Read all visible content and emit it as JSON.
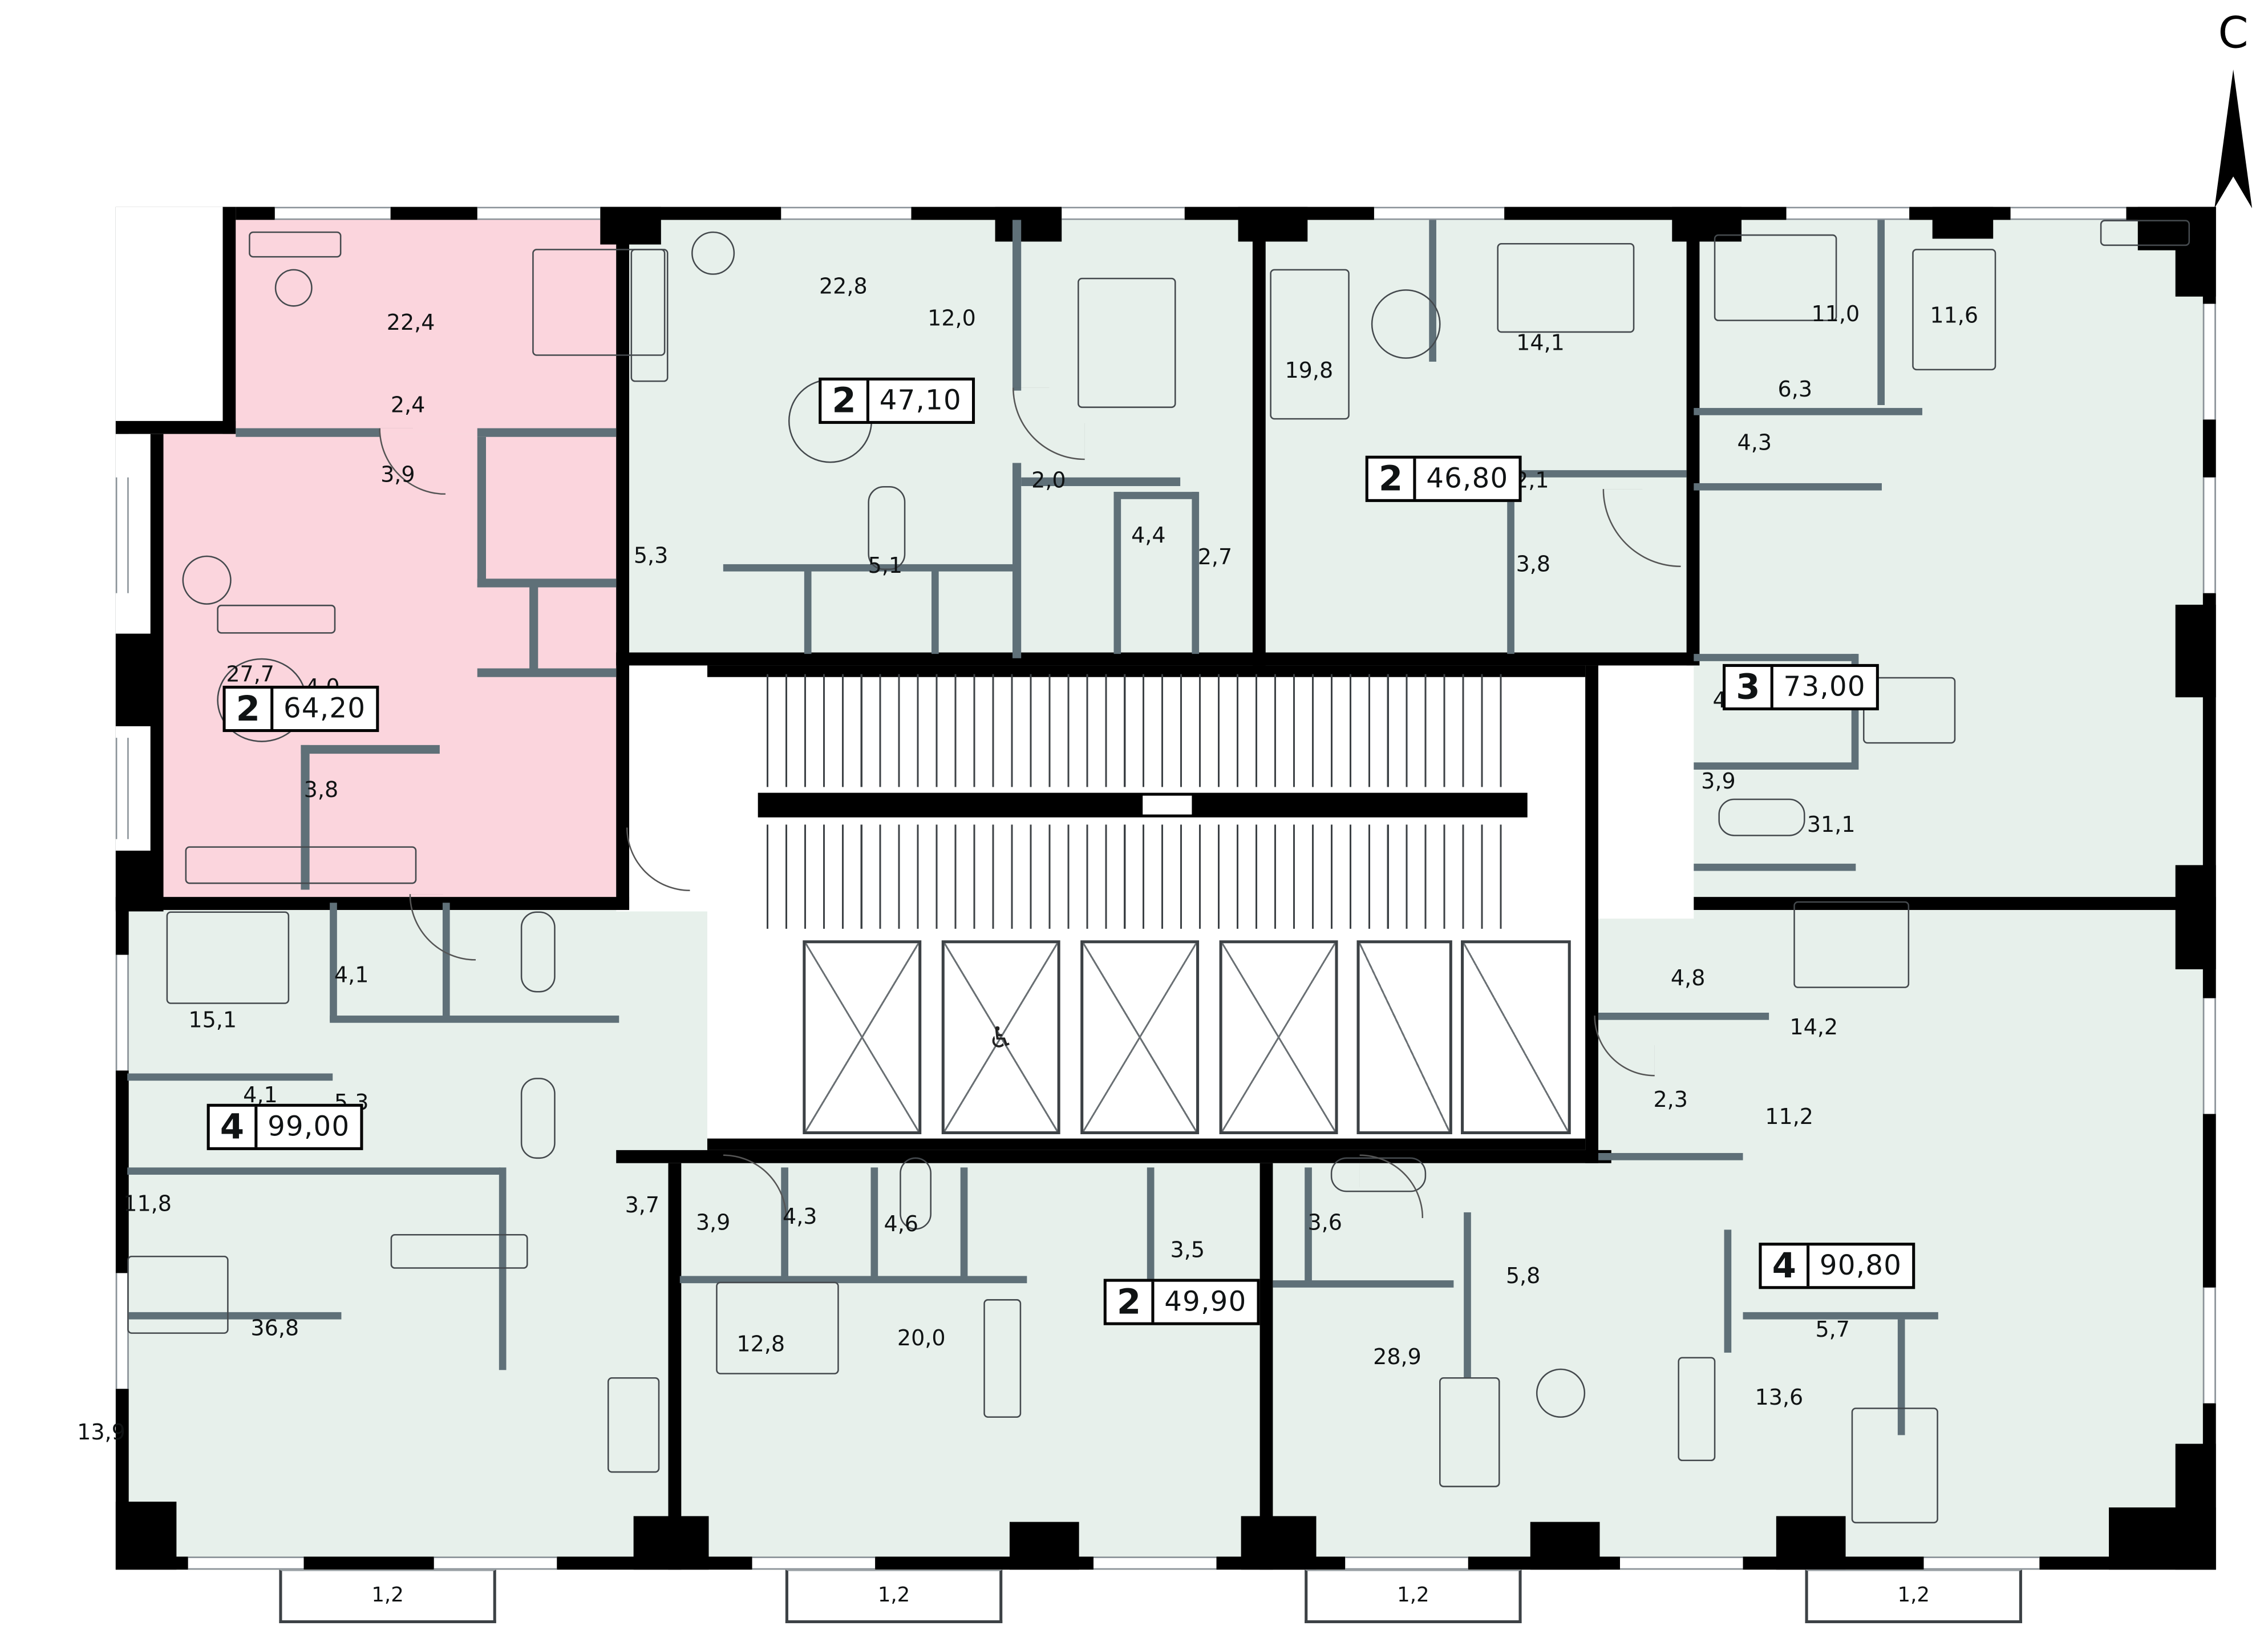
{
  "compass": {
    "label": "С"
  },
  "plan": {
    "balcony_labels": [
      "1,2",
      "1,2",
      "1,2",
      "1,2"
    ],
    "wheelchair_icon": "♿"
  },
  "apartments": [
    {
      "label": "2",
      "area": "64,20",
      "highlighted": true,
      "room_areas": [
        "22,4",
        "2,4",
        "3,9",
        "27,7",
        "4,0",
        "3,8"
      ]
    },
    {
      "label": "2",
      "area": "47,10",
      "highlighted": false,
      "room_areas": [
        "22,8",
        "12,0",
        "2,0",
        "5,3",
        "5,1"
      ]
    },
    {
      "label": "2",
      "area": "46,80",
      "highlighted": false,
      "room_areas": [
        "19,8",
        "14,1",
        "4,4",
        "2,7",
        "2,1",
        "3,8"
      ]
    },
    {
      "label": "3",
      "area": "73,00",
      "highlighted": false,
      "room_areas": [
        "11,0",
        "11,6",
        "6,3",
        "4,3",
        "4,8",
        "3,9",
        "31,1"
      ]
    },
    {
      "label": "4",
      "area": "99,00",
      "highlighted": false,
      "room_areas": [
        "15,1",
        "4,1",
        "4,1",
        "5,3",
        "11,8",
        "3,7",
        "36,8",
        "13,9"
      ]
    },
    {
      "label": "2",
      "area": "49,90",
      "highlighted": false,
      "room_areas": [
        "3,9",
        "4,3",
        "4,6",
        "3,5",
        "12,8",
        "20,0"
      ]
    },
    {
      "label": "4",
      "area": "90,80",
      "highlighted": false,
      "room_areas": [
        "3,6",
        "5,8",
        "28,9",
        "4,8",
        "2,3",
        "14,2",
        "11,2",
        "5,7",
        "13,6"
      ]
    }
  ],
  "colors": {
    "highlight_fill": "#fbd5dd",
    "unit_fill": "#e7f0eb",
    "wall": "#000000",
    "partition": "#5f7078"
  }
}
